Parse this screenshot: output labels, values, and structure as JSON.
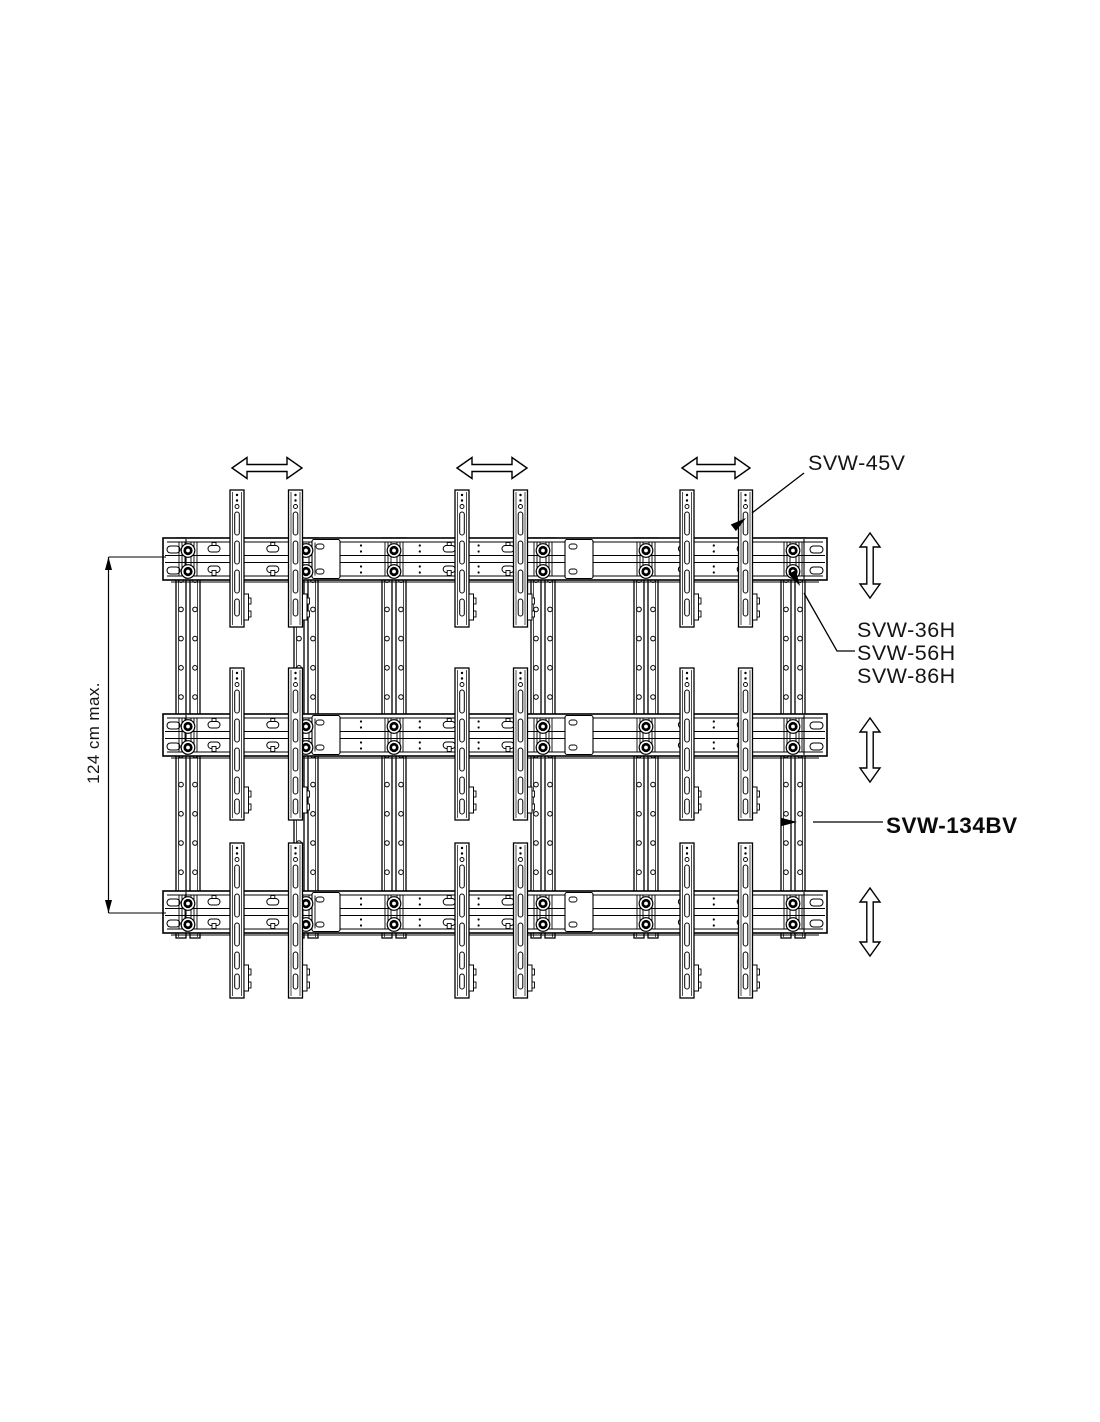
{
  "page": {
    "background": "#ffffff"
  },
  "diagram": {
    "labels": {
      "svw45v": "SVW-45V",
      "svw36h": "SVW-36H",
      "svw56h": "SVW-56H",
      "svw86h": "SVW-86H",
      "svw134bv": "SVW-134BV"
    },
    "dimension": {
      "text": "124 cm max."
    },
    "colors": {
      "line": "#000000",
      "fill": "#ffffff"
    },
    "icons": {
      "horizontal_adjust": "double-headed-horizontal-arrow",
      "vertical_adjust": "double-headed-vertical-arrow",
      "leader": "solid-arrowhead-leader",
      "dimension": "dimension-line-with-arrowheads"
    },
    "structure": {
      "horizontal_rails": 3,
      "vertical_back_rails": 6,
      "display_brackets": 18,
      "horizontal_arrows": 3,
      "vertical_arrows": 3
    }
  }
}
